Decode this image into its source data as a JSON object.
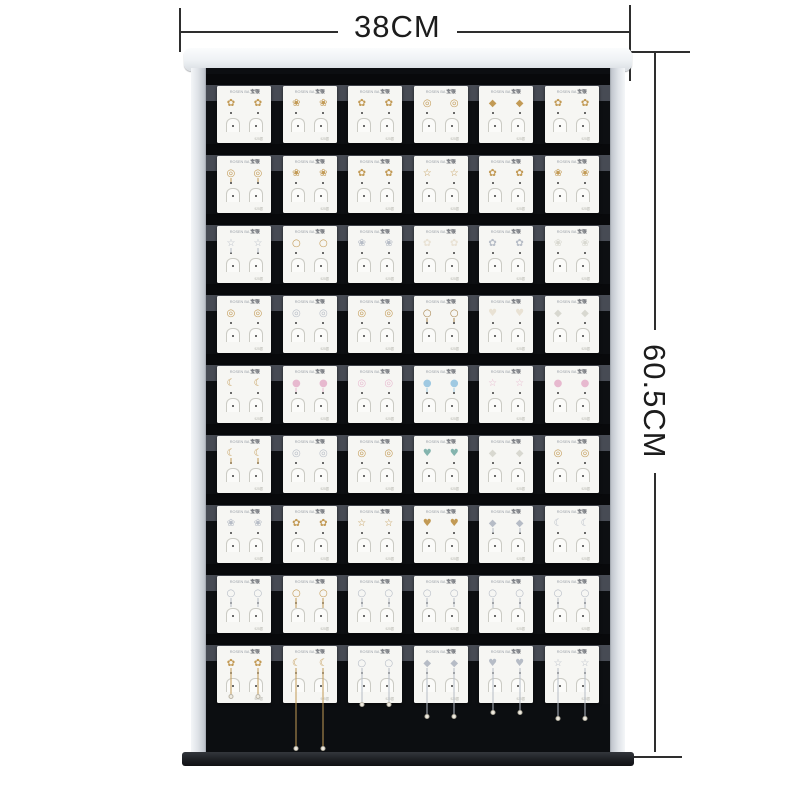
{
  "annotations": {
    "width_label": "38CM",
    "height_label": "60.5CM"
  },
  "colors": {
    "gold": "#c29a55",
    "gold_dark": "#a8854f",
    "silver": "#b6bcc6",
    "pearl": "#e9e2d4",
    "pink": "#e7b9cf",
    "blue": "#9fc9e2",
    "teal": "#84b4ae",
    "white_cz": "#d8d8d0",
    "panel_black": "#0c0e11"
  },
  "rack": {
    "columns": 6,
    "card_brand_left": "ROSEN BA",
    "card_brand_right": "宝银",
    "card_footnote": "925银",
    "rows": [
      {
        "cards": [
          {
            "glyph": "✿",
            "color": "#c29a55",
            "drop": 0,
            "desc": "gold star & pearl studs"
          },
          {
            "glyph": "❀",
            "color": "#c29a55",
            "drop": 0,
            "desc": "gold blossom studs"
          },
          {
            "glyph": "✿",
            "color": "#c29a55",
            "drop": 0,
            "desc": "pearl & gold bow studs"
          },
          {
            "glyph": "◎",
            "color": "#c29a55",
            "drop": 0,
            "desc": "pearl studs"
          },
          {
            "glyph": "◆",
            "color": "#c29a55",
            "drop": 0,
            "desc": "gold bar & pearl studs"
          },
          {
            "glyph": "✿",
            "color": "#c29a55",
            "drop": 0,
            "desc": "gold butterfly studs"
          }
        ]
      },
      {
        "cards": [
          {
            "glyph": "◎",
            "color": "#c29a55",
            "drop": 4,
            "desc": "cherry pearl drops"
          },
          {
            "glyph": "❀",
            "color": "#c29a55",
            "drop": 0,
            "desc": "gold leaf & pearl studs"
          },
          {
            "glyph": "✿",
            "color": "#c29a55",
            "drop": 0,
            "desc": "knot & pearl studs"
          },
          {
            "glyph": "☆",
            "color": "#c29a55",
            "drop": 0,
            "desc": "star cluster studs"
          },
          {
            "glyph": "✿",
            "color": "#c29a55",
            "drop": 0,
            "desc": "bee & pearl studs"
          },
          {
            "glyph": "❀",
            "color": "#c29a55",
            "drop": 0,
            "desc": "flower & pearl studs"
          }
        ]
      },
      {
        "cards": [
          {
            "glyph": "☆",
            "color": "#b6bcc6",
            "drop": 5,
            "desc": "star & pearl dangles"
          },
          {
            "glyph": "○",
            "color": "#c29a55",
            "drop": 0,
            "desc": "gold hoop & pearl studs"
          },
          {
            "glyph": "❀",
            "color": "#b6bcc6",
            "drop": 0,
            "desc": "crystal cluster studs"
          },
          {
            "glyph": "✿",
            "color": "#e9e2d4",
            "drop": 0,
            "desc": "pearl petal studs"
          },
          {
            "glyph": "✿",
            "color": "#b6bcc6",
            "drop": 0,
            "desc": "ribbon & pearl studs"
          },
          {
            "glyph": "❀",
            "color": "#d8d8d0",
            "drop": 0,
            "desc": "daisy studs"
          }
        ]
      },
      {
        "cards": [
          {
            "glyph": "◎",
            "color": "#c29a55",
            "drop": 0,
            "desc": "round halo studs"
          },
          {
            "glyph": "◎",
            "color": "#b6bcc6",
            "drop": 0,
            "desc": "silver rim studs"
          },
          {
            "glyph": "◎",
            "color": "#c29a55",
            "drop": 0,
            "desc": "gold circle studs"
          },
          {
            "glyph": "○",
            "color": "#a8854f",
            "drop": 4,
            "desc": "hoop drop studs"
          },
          {
            "glyph": "♥",
            "color": "#e9e2d4",
            "drop": 0,
            "desc": "pearl heart studs"
          },
          {
            "glyph": "◆",
            "color": "#d8d8d0",
            "drop": 0,
            "desc": "clover studs"
          }
        ]
      },
      {
        "cards": [
          {
            "glyph": "☾",
            "color": "#c29a55",
            "drop": 0,
            "desc": "crescent moon studs"
          },
          {
            "glyph": "●",
            "color": "#e7b9cf",
            "drop": 4,
            "desc": "pink oval drops"
          },
          {
            "glyph": "◎",
            "color": "#e7b9cf",
            "drop": 0,
            "desc": "pink round studs"
          },
          {
            "glyph": "●",
            "color": "#9fc9e2",
            "drop": 4,
            "desc": "blue round drops"
          },
          {
            "glyph": "☆",
            "color": "#e7b9cf",
            "drop": 0,
            "desc": "pink star studs"
          },
          {
            "glyph": "●",
            "color": "#e7b9cf",
            "drop": 0,
            "desc": "pink round & star studs"
          }
        ]
      },
      {
        "cards": [
          {
            "glyph": "☾",
            "color": "#c29a55",
            "drop": 6,
            "desc": "gold chain dangles"
          },
          {
            "glyph": "◎",
            "color": "#b6bcc6",
            "drop": 0,
            "desc": "silver halo studs"
          },
          {
            "glyph": "◎",
            "color": "#c29a55",
            "drop": 0,
            "desc": "gold gem circle studs"
          },
          {
            "glyph": "♥",
            "color": "#84b4ae",
            "drop": 0,
            "desc": "abalone heart studs"
          },
          {
            "glyph": "◆",
            "color": "#d8d8d0",
            "drop": 0,
            "desc": "clover square studs"
          },
          {
            "glyph": "◎",
            "color": "#c29a55",
            "drop": 0,
            "desc": "gold round studs"
          }
        ]
      },
      {
        "cards": [
          {
            "glyph": "❀",
            "color": "#b6bcc6",
            "drop": 0,
            "desc": "crystal fan studs"
          },
          {
            "glyph": "✿",
            "color": "#c29a55",
            "drop": 0,
            "desc": "gold butterfly studs"
          },
          {
            "glyph": "☆",
            "color": "#c29a55",
            "drop": 0,
            "desc": "gold branch studs"
          },
          {
            "glyph": "♥",
            "color": "#c29a55",
            "drop": 0,
            "desc": "heart outline studs"
          },
          {
            "glyph": "◆",
            "color": "#b6bcc6",
            "drop": 5,
            "desc": "fan drop earrings"
          },
          {
            "glyph": "☾",
            "color": "#b6bcc6",
            "drop": 0,
            "desc": "cat & fish studs"
          }
        ]
      },
      {
        "cards": [
          {
            "glyph": "○",
            "color": "#b6bcc6",
            "drop": 9,
            "desc": "oval drop earrings"
          },
          {
            "glyph": "○",
            "color": "#c29a55",
            "drop": 10,
            "desc": "rectangle link drops"
          },
          {
            "glyph": "○",
            "color": "#b6bcc6",
            "drop": 9,
            "desc": "hoop drops"
          },
          {
            "glyph": "○",
            "color": "#b6bcc6",
            "drop": 9,
            "desc": "knot drops"
          },
          {
            "glyph": "○",
            "color": "#b6bcc6",
            "drop": 10,
            "desc": "double circle drops"
          },
          {
            "glyph": "○",
            "color": "#b6bcc6",
            "drop": 10,
            "desc": "twist teardrop drops"
          }
        ]
      },
      {
        "cards": [
          {
            "glyph": "✿",
            "color": "#c29a55",
            "drop": 26,
            "desc": "spider & chain dangles"
          },
          {
            "glyph": "☾",
            "color": "#c29a55",
            "drop": 78,
            "desc": "moon & star tassel threaders"
          },
          {
            "glyph": "○",
            "color": "#b6bcc6",
            "drop": 34,
            "desc": "paperclip threaders"
          },
          {
            "glyph": "◆",
            "color": "#b6bcc6",
            "drop": 46,
            "desc": "clover chain & pearl dangles"
          },
          {
            "glyph": "♥",
            "color": "#b6bcc6",
            "drop": 42,
            "desc": "heart & pearl chain dangles"
          },
          {
            "glyph": "☆",
            "color": "#b6bcc6",
            "drop": 48,
            "desc": "star chain tassel dangles"
          }
        ]
      }
    ]
  }
}
